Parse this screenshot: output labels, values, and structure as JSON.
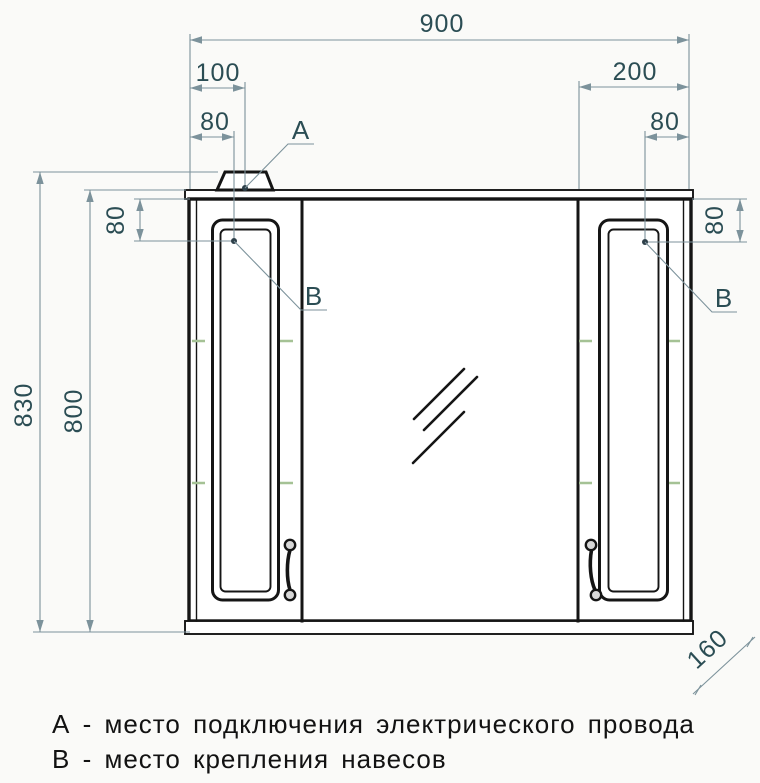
{
  "dimensions": {
    "overall_width": "900",
    "power_point_offset": "100",
    "hinge_inset_left": "80",
    "right_section_width": "200",
    "hinge_inset_right": "80",
    "overall_height": "830",
    "cabinet_height": "800",
    "hinge_top_inset_left": "80",
    "hinge_top_inset_right": "80",
    "depth": "160"
  },
  "markers": {
    "power": "А",
    "hinge_left": "В",
    "hinge_right": "В"
  },
  "legend": {
    "line_a": "А - место подключения электрического провода",
    "line_b": "В - место крепления навесов"
  },
  "colors": {
    "bg": "#fafaf8",
    "line": "#151515",
    "dim": "#7c929b",
    "dimtext": "#2b4d54",
    "dash": "#a5c295",
    "dot": "#2d3f49",
    "ink": "#121212",
    "handlefill": "#d8d8d8"
  }
}
